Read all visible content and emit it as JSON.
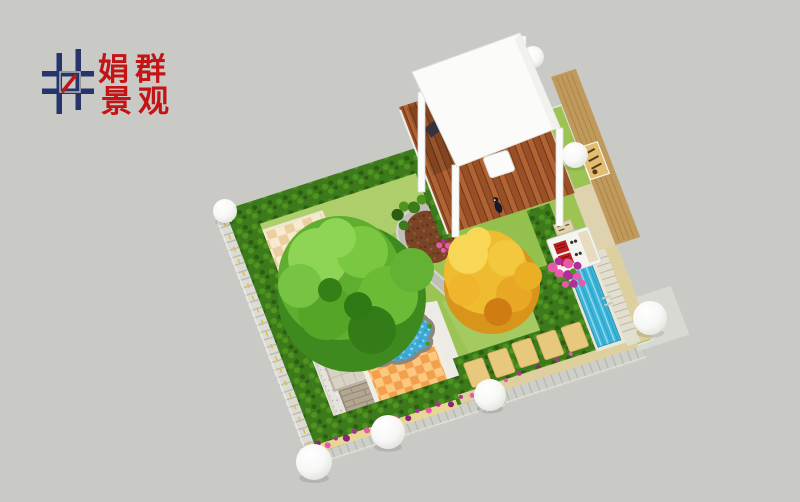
{
  "canvas": {
    "width": 800,
    "height": 502,
    "background": "#c9c9c6"
  },
  "logo": {
    "line1": "娟群",
    "line2": "景观",
    "text_color": "#c41414",
    "mark_navy": "#27356d",
    "mark_red": "#c41414"
  },
  "palette": {
    "background": "#c9c9c6",
    "lawn": "#9cc455",
    "lawn_light": "#b7d476",
    "lawn_mid": "#8bbc47",
    "hedge": "#3c7a1c",
    "hedge_light": "#4f941f",
    "hedge_dark": "#2c5e12",
    "tree_green_dark": "#3f8a1e",
    "tree_green": "#5fae2f",
    "tree_green_light": "#8ed455",
    "tree_yellow": "#eebc2e",
    "tree_yellow_light": "#f7d755",
    "tree_orange": "#d9941c",
    "deck_brown": "#9a5026",
    "deck_brown_dark": "#6e3417",
    "deck_brown_light": "#b06434",
    "pergola_white": "#fbfbfa",
    "pond_blue": "#3fa9d6",
    "pond_blue_light": "#8fd4ef",
    "pool_blue": "#3cb4d8",
    "pool_blue_light": "#8fdcf0",
    "rock_gray": "#8d867a",
    "rock_brown": "#6e3a28",
    "mulch": "#7a4526",
    "mulch_dark": "#5e3018",
    "path_gray": "#bfbfb8",
    "path_gray_light": "#d6d6d0",
    "white_paving": "#ecebe5",
    "gravel": "#e5e3dc",
    "gravel_dot": "#b9b6ac",
    "stone_pad": "#d8d2c4",
    "brick_pad": "#b3a692",
    "patio_tan": "#f7ead0",
    "patio_tan_dark": "#ebcfa0",
    "patio_orange": "#fbc87e",
    "patio_orange_dark": "#f2a04e",
    "stepstone": "#e8c87c",
    "sand_tan": "#ddcf9e",
    "wall_gray": "#cfcfca",
    "pillar_gray": "#d9d9d4",
    "fence_gray": "#dcdcd6",
    "fence_line": "#b5b5ae",
    "timber_wall": "#c09a5c",
    "timber_line": "#a9823f",
    "bench_tan": "#e2bd72",
    "bbq_white": "#f4f4f1",
    "bbq_red": "#bf1f1f",
    "cream_stone": "#dfd2ae",
    "pool_coping": "#e8e6da",
    "stair_stone": "#e3dfcf",
    "flower_pink": "#e85aa8",
    "flower_magenta": "#b22d9b",
    "flower_purple": "#8c2478",
    "vine_yellow": "#e7d794",
    "yellow_dash": "#e0c048",
    "sphere_edge": "#ddddd8",
    "logo_navy": "#27356d",
    "logo_red": "#c41414",
    "person_dark": "#191926"
  },
  "scene": {
    "elements": [
      "pergola-canopy",
      "wood-deck",
      "timber-feature-wall",
      "garden-bench",
      "barbecue-unit",
      "lap-pool",
      "pool-ladder",
      "garden-pond",
      "rock-waterfall",
      "large-green-tree",
      "golden-tree",
      "lawn",
      "clipped-hedges",
      "mulch-planting-bed",
      "curved-stone-path",
      "checkered-tile-patio-upper",
      "checkered-tile-patio-lower",
      "gravel-court",
      "stone-paver-pads",
      "stepping-stone-path",
      "perimeter-wall",
      "perimeter-fence",
      "sphere-lamps",
      "bougainvillea",
      "flower-border",
      "person-figure",
      "outdoor-table"
    ]
  }
}
